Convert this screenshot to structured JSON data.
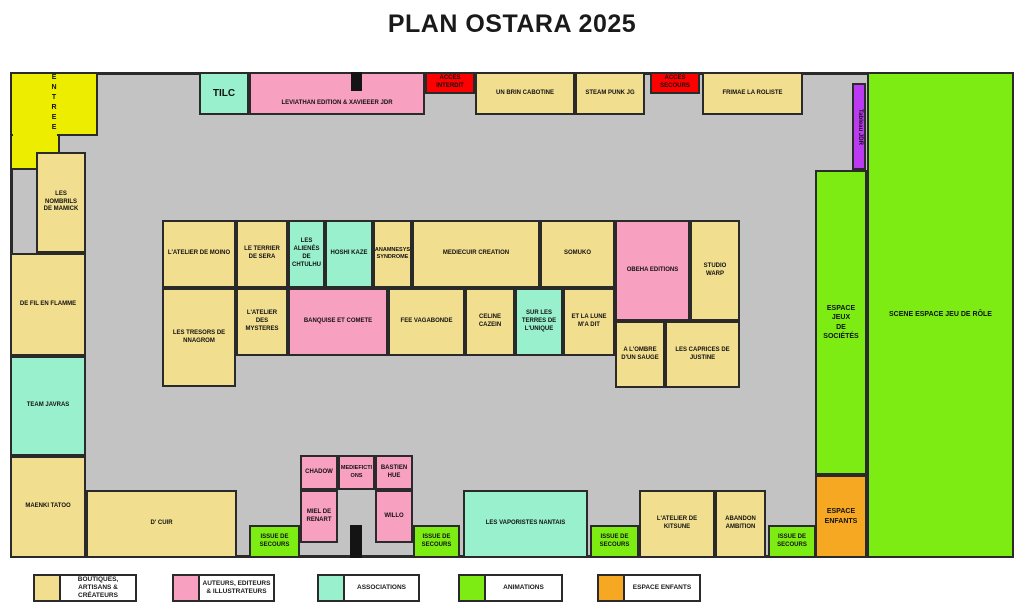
{
  "title": "PLAN OSTARA 2025",
  "colors": {
    "boutiques_artisans_createurs": "#F1DE8E",
    "auteurs_editeurs_illustrateurs": "#F8A0C0",
    "associations": "#98F0CC",
    "animations": "#7CEC12",
    "espace_enfants": "#F7A823",
    "acces": "#FF0000",
    "entree": "#EDED00",
    "tableau_jdr": "#BB3AF2",
    "hall_floor": "#C3C3C3"
  },
  "booths": {
    "entree": "ENTREE",
    "tilc": "TILC",
    "leviathan": "LEVIATHAN EDITION & XAVIEEER JDR",
    "acces_interdit": "ACCES\nINTERDIT",
    "un_brin_cabotine": "UN BRIN CABOTINE",
    "steam_punk_jg": "STEAM PUNK JG",
    "acces_secours": "ACCES\nSECOURS",
    "frimae_la_roliste": "FRIMAE LA ROLISTE",
    "tableau_jdr": "Tableau JDR",
    "scene_espace_jdr": "SCENE ESPACE JEU DE RÔLE",
    "espace_jeux_societes": "ESPACE JEUX\nDE SOCIÉTÉS",
    "espace_enfants": "ESPACE\nENFANTS",
    "nombrils_mamick": "LES\nNOMBRILS\nDE MAMICK",
    "de_fil_en_flamme": "DE FIL EN FLAMME",
    "team_javras": "TEAM JAVRAS",
    "maenki_tatoo": "MAENKI TATOO",
    "atelier_de_moino": "L'ATELIER DE MOINO",
    "terrier_de_sera": "LE TERRIER\nDE SERA",
    "alienes_de_chtulhu": "LES\nALIENÉS\nDE\nCHTULHU",
    "hoshi_kaze": "HOSHI KAZE",
    "anamnesys_syndrome": "ANAMNESYS\nSYNDROME",
    "mediecuir_creation": "MEDIECUIR CREATION",
    "somuko": "SOMUKO",
    "tresors_nnagrom": "LES TRESORS DE\nNNAGROM",
    "atelier_des_mysteres": "L'ATELIER\nDES\nMYSTERES",
    "banquise_et_comete": "BANQUISE ET COMETE",
    "fee_vagabonde": "FEE VAGABONDE",
    "celine_cazein": "CELINE\nCAZEIN",
    "sur_les_terres_de_lunique": "SUR LES\nTERRES DE\nL'UNIQUE",
    "et_la_lune_ma_dit": "ET LA LUNE\nM'A DIT",
    "obeha_editions": "OBEHA EDITIONS",
    "studio_warp": "STUDIO\nWARP",
    "a_lombre_dun_sauge": "A L'OMBRE\nD'UN SAUGE",
    "caprices_de_justine": "LES CAPRICES DE\nJUSTINE",
    "chadow": "CHADOW",
    "mediefictions": "MEDIEFICTI\nONS",
    "bastien_hue": "BASTIEN\nHUE",
    "miel_de_renart": "MIEL DE\nRENART",
    "willo": "WILLO",
    "d_cuir": "D' CUIR",
    "vaporistes_nantais": "LES VAPORISTES NANTAIS",
    "atelier_de_kitsune": "L'ATELIER DE\nKITSUNE",
    "abandon_ambition": "ABANDON\nAMBITION",
    "issue_de_secours": "ISSUE DE\nSECOURS"
  },
  "legend": {
    "items": [
      {
        "label": "BOUTIQUES,\nARTISANS &\nCRÉATEURS",
        "color": "#F1DE8E"
      },
      {
        "label": "AUTEURS, EDITEURS\n& ILLUSTRATEURS",
        "color": "#F8A0C0"
      },
      {
        "label": "ASSOCIATIONS",
        "color": "#98F0CC"
      },
      {
        "label": "ANIMATIONS",
        "color": "#7CEC12"
      },
      {
        "label": "ESPACE ENFANTS",
        "color": "#F7A823"
      }
    ]
  }
}
